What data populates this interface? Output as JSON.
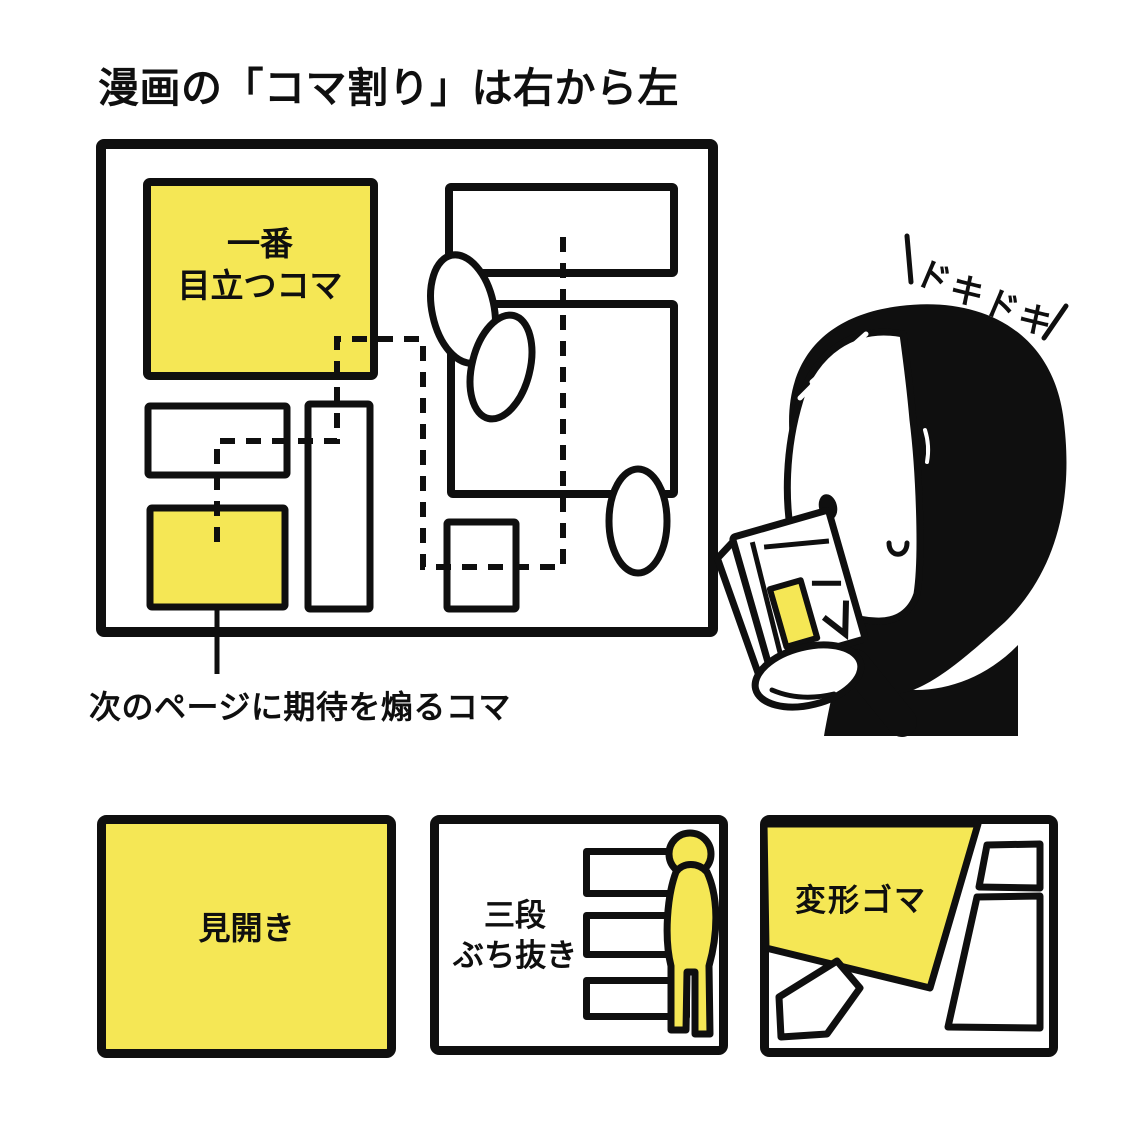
{
  "title": "漫画の「コマ割り」は右から左",
  "colors": {
    "yellow": "#f5e755",
    "ink": "#0f0f0f",
    "paper": "#ffffff"
  },
  "main_diagram": {
    "most_striking_panel": {
      "line1": "一番",
      "line2": "目立つコマ"
    },
    "caption": "次のページに期待を煽るコマ"
  },
  "reader": {
    "sfx": "ドキドキ"
  },
  "legend_panels": [
    {
      "label": "見開き"
    },
    {
      "lines": [
        "三段",
        "ぶち抜き"
      ]
    },
    {
      "label": "変形ゴマ"
    }
  ]
}
